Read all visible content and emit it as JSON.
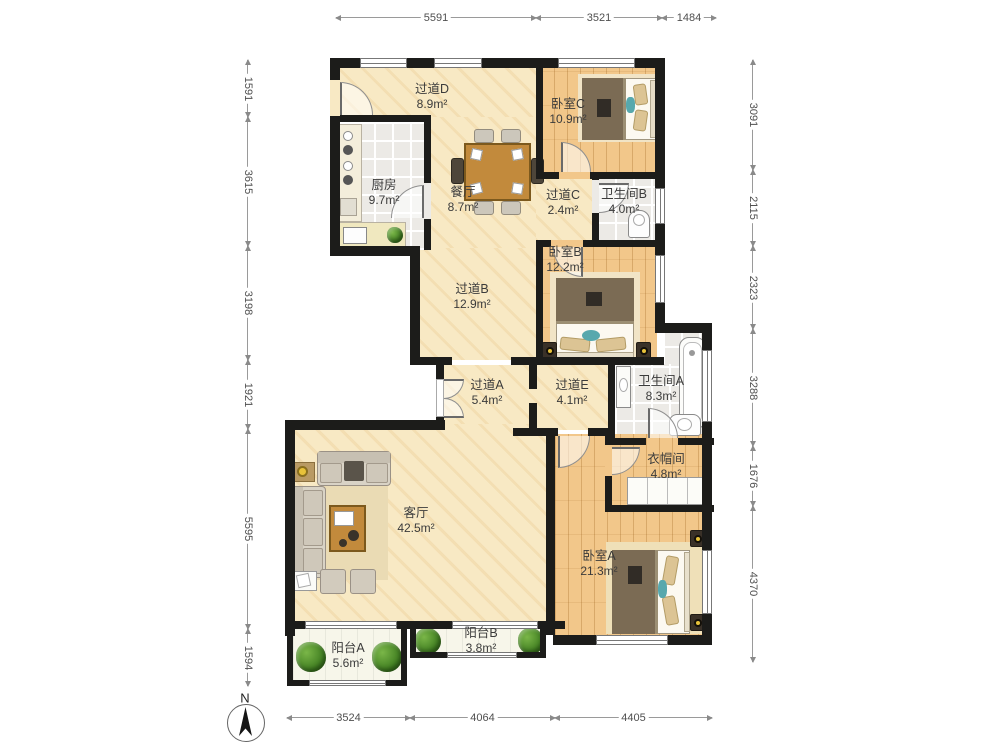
{
  "plan_title": "apartment-floor-plan",
  "compass": {
    "label": "N"
  },
  "rooms": [
    {
      "name": "过道D",
      "area": "8.9m²"
    },
    {
      "name": "厨房",
      "area": "9.7m²"
    },
    {
      "name": "餐厅",
      "area": "8.7m²"
    },
    {
      "name": "卧室C",
      "area": "10.9m²"
    },
    {
      "name": "过道C",
      "area": "2.4m²"
    },
    {
      "name": "卫生间B",
      "area": "4.0m²"
    },
    {
      "name": "卧室B",
      "area": "12.2m²"
    },
    {
      "name": "过道B",
      "area": "12.9m²"
    },
    {
      "name": "过道A",
      "area": "5.4m²"
    },
    {
      "name": "过道E",
      "area": "4.1m²"
    },
    {
      "name": "卫生间A",
      "area": "8.3m²"
    },
    {
      "name": "衣帽间",
      "area": "4.8m²"
    },
    {
      "name": "客厅",
      "area": "42.5m²"
    },
    {
      "name": "卧室A",
      "area": "21.3m²"
    },
    {
      "name": "阳台A",
      "area": "5.6m²"
    },
    {
      "name": "阳台B",
      "area": "3.8m²"
    }
  ],
  "dimensions": {
    "top": [
      "5591",
      "3521",
      "1484"
    ],
    "bottom": [
      "3524",
      "4064",
      "4405"
    ],
    "left": [
      "1591",
      "3615",
      "3198",
      "1921",
      "5595",
      "1594"
    ],
    "right": [
      "3091",
      "2115",
      "2323",
      "3288",
      "1676",
      "4370"
    ]
  },
  "colors": {
    "wall": "#1c1c1a",
    "floor_cream": "#f8e9c4",
    "floor_wood": "#f2c78a",
    "floor_tile": "#eceae6",
    "floor_balcony": "#f7f6ea",
    "plant_green": "#3f7d20",
    "table_wood": "#c28a3c",
    "duvet_brown": "#7b6b54"
  }
}
